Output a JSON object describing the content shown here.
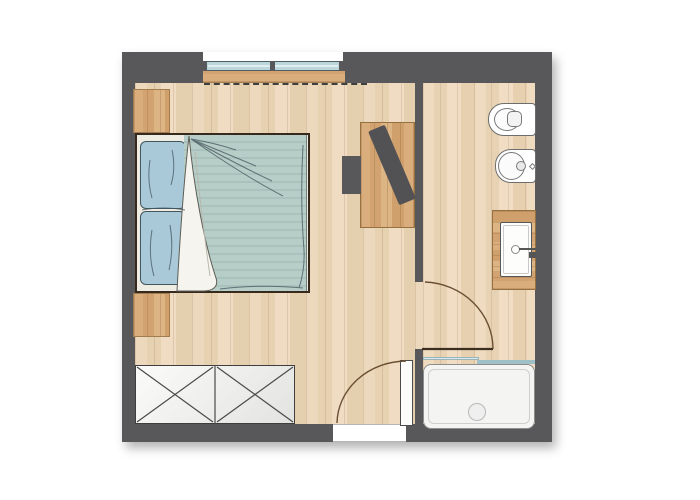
{
  "plan": {
    "name": "Hotel room floor plan — bedroom with en-suite bathroom",
    "rooms": [
      {
        "name": "Bedroom",
        "items": [
          "double bed",
          "pillow",
          "pillow",
          "duvet",
          "folded sheet",
          "nightstand",
          "nightstand",
          "wardrobe dresser",
          "desk",
          "chair",
          "tv",
          "window",
          "entrance door"
        ]
      },
      {
        "name": "Bathroom",
        "items": [
          "toilet",
          "bidet",
          "vanity counter",
          "washbasin",
          "faucet",
          "shower tray",
          "shower glass partition",
          "bathroom door"
        ]
      }
    ],
    "labels": {
      "bed": "Double bed",
      "pillow1": "Pillow (left/top)",
      "pillow2": "Pillow (left/bottom)",
      "duvet": "Duvet with fold-back sheet",
      "nightstand_top": "Nightstand",
      "nightstand_bottom": "Nightstand",
      "wardrobe": "Wardrobe / dresser (X-front, 2 doors)",
      "desk": "Desk",
      "chair": "Chair",
      "tv": "TV on desk",
      "window": "Double window",
      "sill": "Window sill",
      "dashed_line": "Overhead edge (dashed)",
      "entrance_door": "Entrance door (opens into room)",
      "entrance_threshold": "Entrance threshold",
      "bathroom_door": "Bathroom door (opens into bathroom)",
      "toilet": "Wall-hung toilet",
      "bidet": "Bidet",
      "counter": "Vanity counter",
      "basin": "Washbasin",
      "shower": "Shower tray with drain",
      "glass": "Shower glass partition",
      "bedroom_floor": "Bedroom wood floor",
      "bathroom_floor": "Bathroom wood floor",
      "wall": "Wall"
    },
    "colors": {
      "wall": "#58585a",
      "floor_light_wood": "#e9d5b6",
      "accent_wood": "#d5a876",
      "duvet_teal": "#b6cec7",
      "duvet_stripe": "#a9c2bb",
      "pillow_blue": "#a9c9d8",
      "sheet_white": "#f6f4ee",
      "window_glass": "#bcd7db",
      "shower_glass": "#9fc0c6",
      "door_arc_brown": "#6b4f33",
      "fixture_outline": "#6d6d6d",
      "dresser_fill": "#f2f2f0"
    }
  }
}
